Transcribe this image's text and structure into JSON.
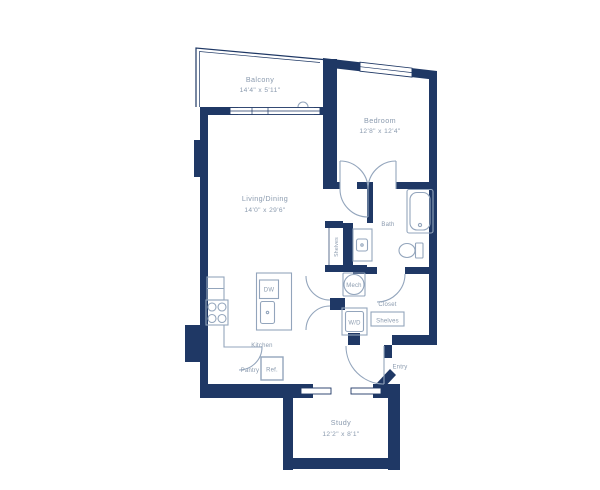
{
  "colors": {
    "wall": "#1f3865",
    "line": "#93a5bc",
    "text": "#8a9aae"
  },
  "rooms": {
    "balcony": {
      "name": "Balcony",
      "dims": "14'4\" x 5'11\""
    },
    "bedroom": {
      "name": "Bedroom",
      "dims": "12'8\" x 12'4\""
    },
    "living": {
      "name": "Living/Dining",
      "dims": "14'0\" x 29'6\""
    },
    "study": {
      "name": "Study",
      "dims": "12'2\" x 8'1\""
    },
    "bath": {
      "name": "Bath"
    },
    "kitchen": {
      "name": "Kitchen"
    },
    "closet": {
      "name": "Closet"
    },
    "entry": {
      "name": "Entry"
    }
  },
  "fixtures": {
    "dw": "DW",
    "ref": "Ref.",
    "pantry": "Pantry",
    "mech": "Mech",
    "wd": "W/D",
    "closet_shelves": "Shelves",
    "linen_shelves": "Shelves"
  }
}
